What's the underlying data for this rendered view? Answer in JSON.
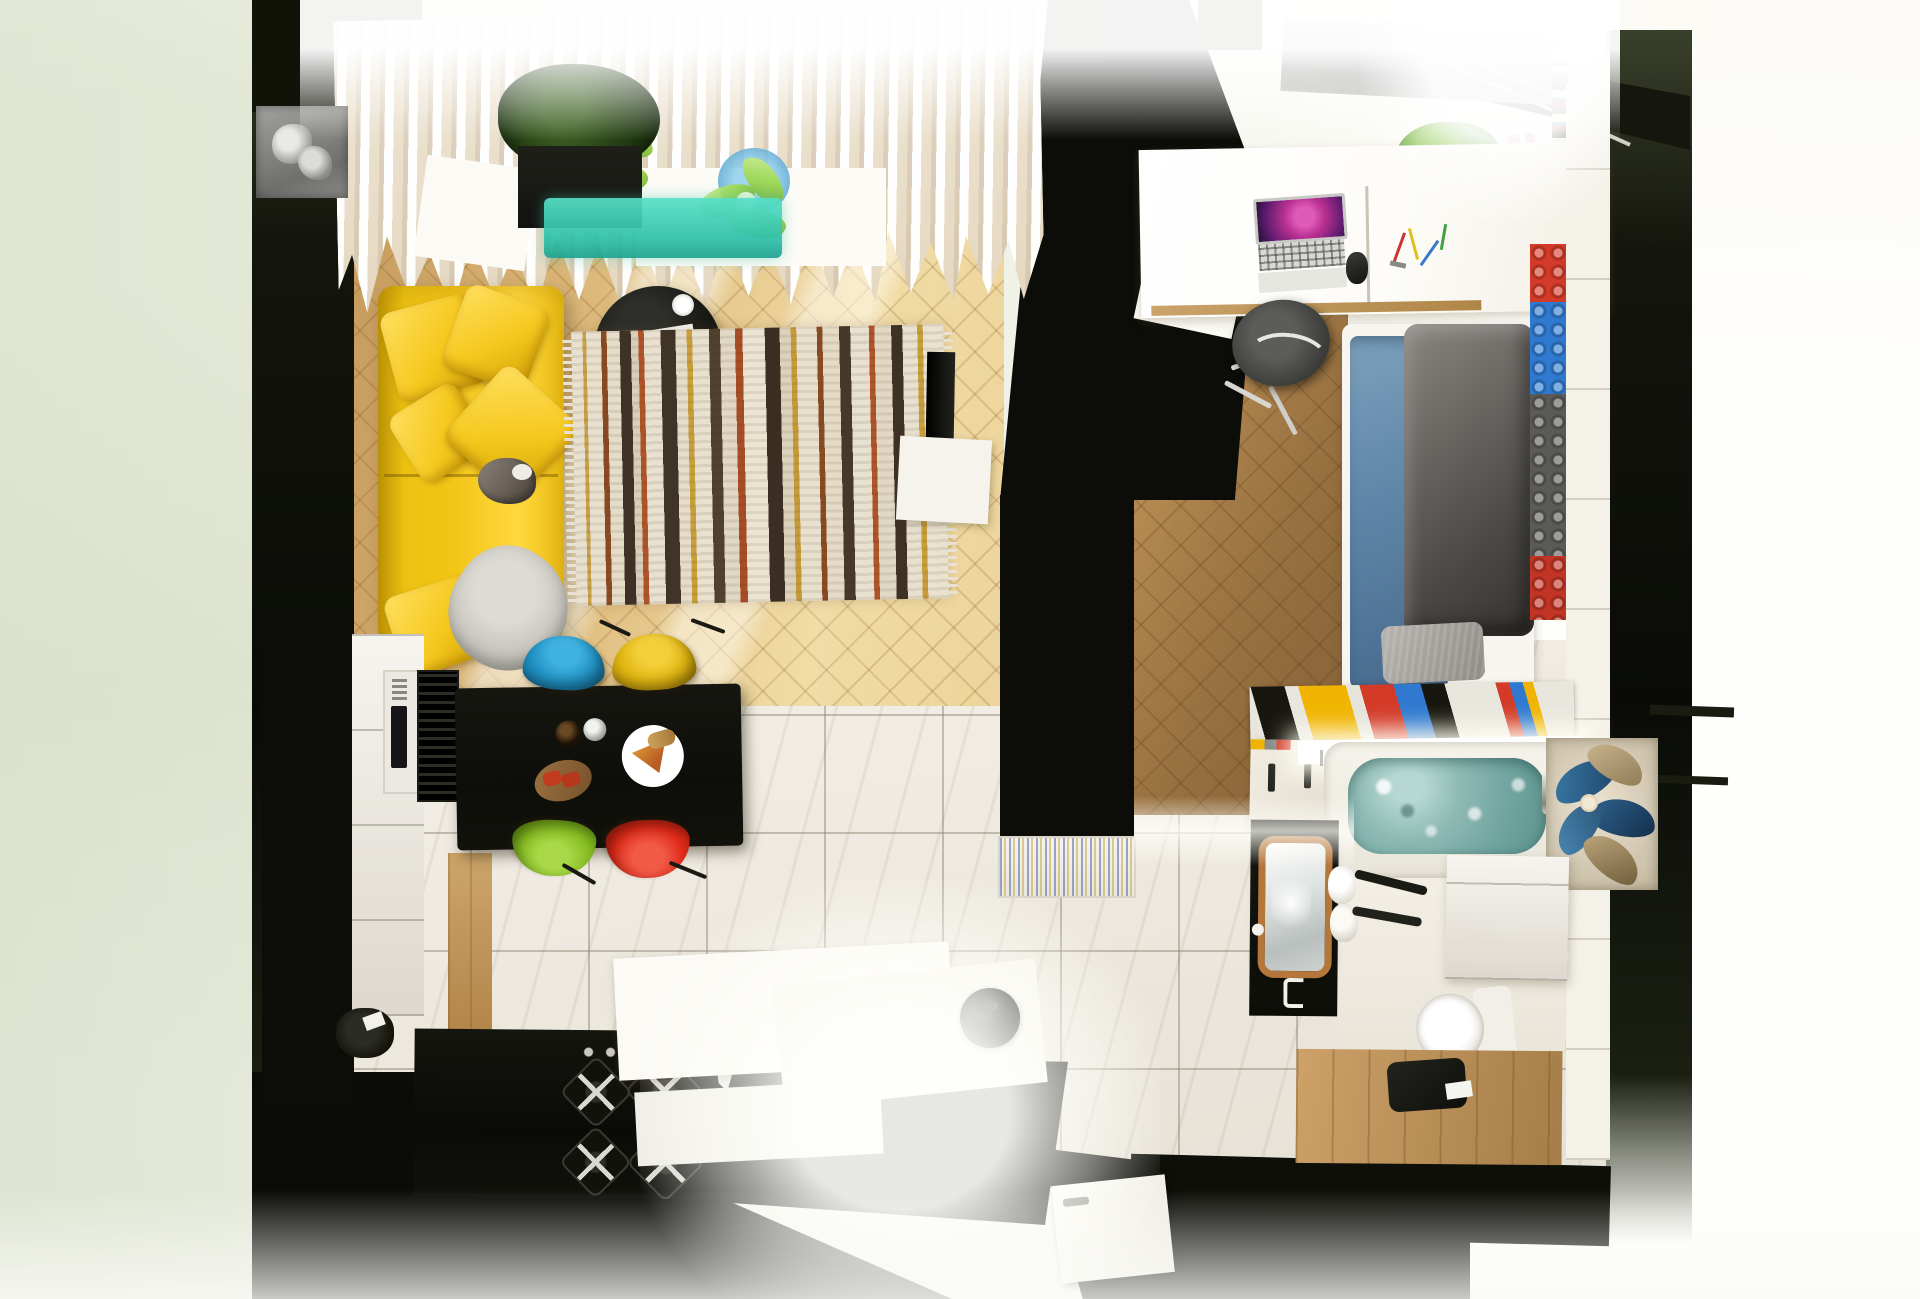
{
  "scene": {
    "type": "3d-render",
    "view": "top-down floor plan render",
    "subject": "studio apartment with living room, kitchen-dining area, bedroom and bathroom",
    "rooms": [
      {
        "name": "living-room",
        "floor": "herringbone oak",
        "items": [
          "white-pleated-curtains",
          "window-glass-flowers",
          "gray-ac-radiator-unit",
          "black-planter-with-ivy",
          "teal-glass-aquarium",
          "yellow-sofa",
          "yellow-throw-pillows",
          "gray-knit-throw",
          "cat-on-sofa",
          "black-round-coffee-table",
          "white-coffee-cup",
          "open-magazine",
          "boho-striped-rug",
          "wall-mounted-tv",
          "white-tv-console"
        ]
      },
      {
        "name": "kitchen-dining",
        "floor": "white marble tile",
        "items": [
          "black-dining-table",
          "wine-bottle",
          "metal-shaker",
          "pizza-plate",
          "bruschetta-board",
          "blue-shell-chair",
          "yellow-shell-chair",
          "green-shell-chair",
          "red-shell-chair",
          "white-cabinet-run",
          "built-in-microwave",
          "black-vent-grille",
          "black-stove-counter",
          "gas-burners",
          "entry-console-slabs",
          "robot-vacuum",
          "patterned-doormat",
          "entry-door"
        ]
      },
      {
        "name": "bedroom",
        "floor": "dark herringbone oak",
        "items": [
          "skylight-windows",
          "roller-blind-housing",
          "white-bookshelf",
          "potted-plants",
          "white-desk",
          "open-laptop",
          "computer-mouse",
          "scattered-pens",
          "gray-office-chair",
          "white-frame-bed",
          "blue-sheets",
          "gray-duvet",
          "gray-pillow",
          "lego-brick-accent-wall"
        ]
      },
      {
        "name": "bathroom",
        "floor": "marble and wood",
        "items": [
          "lego-brick-trim",
          "white-wardrobe-top",
          "bathtub",
          "teal-bath-water",
          "glass-bottle-shelf",
          "chrome-shower-screen",
          "floral-glass-mural",
          "white-vanity",
          "toilet",
          "wood-framed-mirror-door",
          "rolled-white-towels",
          "towel-rack",
          "wood-bench-counter",
          "black-stool"
        ]
      }
    ],
    "palette": {
      "woodLiving": "#d8ae72",
      "woodBed": "#b78a52",
      "marble": "#efebe2",
      "wallDark": "#0c0d08",
      "wallOlive": "#39402a",
      "curtain": "#efe7d6",
      "sofaYellow": "#f2c516",
      "tealGlass": "#3cc3ab",
      "bathWater": "#85b3ae",
      "chairBlue": "#1f8fc0",
      "chairYellow": "#dfb40e",
      "chairGreen": "#86bd20",
      "chairRed": "#df2a18",
      "bedBlue": "#5f86a8",
      "duvetGray": "#57524d",
      "legoRed": "#d43a28",
      "legoBlue": "#2f7ad0",
      "legoYellow": "#f0b400",
      "laptopScreenPink": "#c8399b",
      "muralBlue": "#3a6e96"
    }
  }
}
